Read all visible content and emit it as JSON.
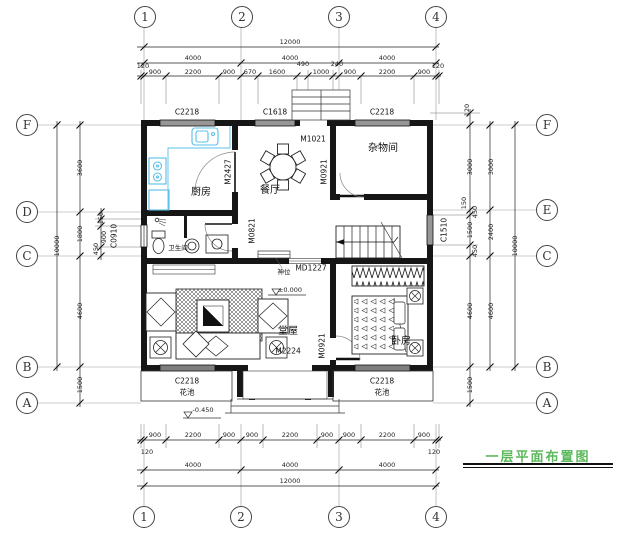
{
  "title": {
    "text": "一层平面布置图",
    "color": "#5cb85c"
  },
  "axis_bubbles": {
    "top": [
      "1",
      "2",
      "3",
      "4"
    ],
    "bottom": [
      "1",
      "2",
      "3",
      "4"
    ],
    "left": [
      "F",
      "D",
      "C",
      "B",
      "A"
    ],
    "right": [
      "F",
      "E",
      "C",
      "B",
      "A"
    ]
  },
  "rooms": {
    "kitchen": "厨房",
    "dining": "餐厅",
    "storage": "杂物间",
    "bath": "卫生间",
    "hall": "堂屋",
    "bedroom": "卧房",
    "flower_left": "花池",
    "flower_right": "花池",
    "shrine": "神位"
  },
  "openings": {
    "win_top_left": "C2218",
    "win_top_mid": "C1618",
    "win_top_right": "C2218",
    "win_left": "C0910",
    "win_right": "C1510",
    "win_bottom_left": "C2218",
    "win_bottom_right": "C2218",
    "door_kitchen": "M2427",
    "door_back": "M1021",
    "door_storage": "M0921",
    "door_bath": "M0821",
    "door_hall": "MD1227",
    "door_main": "M2224",
    "door_bedroom": "M0921"
  },
  "levels": {
    "indoor": "±0.000",
    "outdoor": "-0.450"
  },
  "dims": {
    "top": {
      "overall": "12000",
      "axis": [
        "4000",
        "4000",
        "4000"
      ],
      "detail": [
        "120",
        "900",
        "2200",
        "900",
        "670",
        "1600",
        "490",
        "1000",
        "240",
        "900",
        "2200",
        "900",
        "120"
      ]
    },
    "bottom": {
      "overall": "12000",
      "axis": [
        "4000",
        "4000",
        "4000"
      ],
      "detail": [
        "900",
        "2200",
        "900",
        "900",
        "2200",
        "900",
        "900",
        "2200",
        "900"
      ],
      "edge": [
        "120",
        "120"
      ]
    },
    "left": {
      "overall": "10000",
      "axis": [
        "3600",
        "1800",
        "4600",
        "1500"
      ],
      "detail": [
        "150",
        "900",
        "450"
      ]
    },
    "right": {
      "overall": "10000",
      "axis": [
        "3000",
        "2400",
        "4600"
      ],
      "detail": [
        "120",
        "3000",
        "150",
        "450",
        "1500",
        "450",
        "4600",
        "1500"
      ]
    }
  }
}
